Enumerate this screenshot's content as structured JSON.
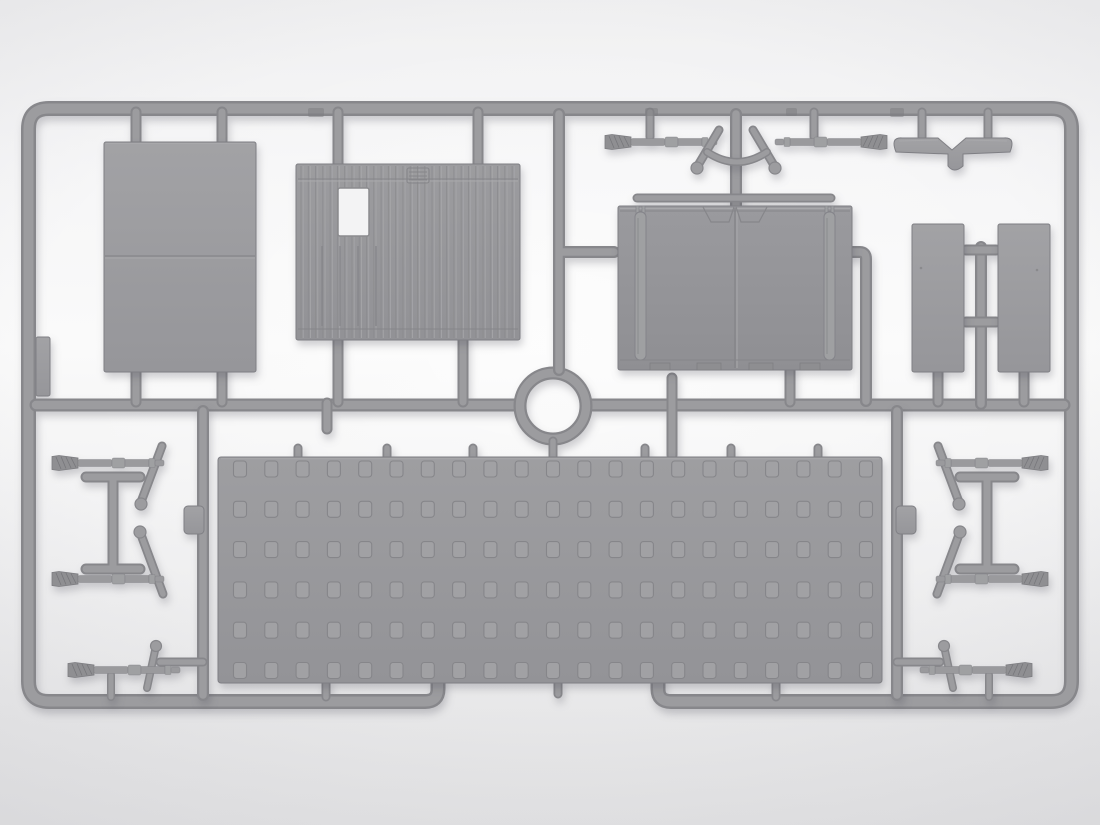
{
  "image": {
    "type": "photograph",
    "subject": "Gray injection-molded plastic model kit sprue (parts frame) on a light studio background",
    "orientation": "landscape",
    "visible_text": ""
  },
  "colors": {
    "bg_top": "#f0f0f1",
    "bg_mid": "#fafafa",
    "bg_bottom": "#e6e6e7",
    "runner_dark": "#87878b",
    "runner_light": "#9c9c9f",
    "part_light": "#a2a2a5",
    "part_dark": "#96969a",
    "corr_light": "#9c9c9f",
    "corr_dark": "#929296",
    "door_light": "#9a9a9e",
    "door_dark": "#8f8f93",
    "floor_light": "#9e9ea1",
    "floor_dark": "#939397",
    "outline": "#7f7f84",
    "detail_dark": "#86868a",
    "detail_light": "#a8a8ab",
    "hole_fill": "#a1a1a4",
    "window_fill": "#f3f3f4",
    "shadow": "rgba(70,70,85,0.25)"
  },
  "parts": [
    {
      "name": "roof-panel",
      "desc": "large plain rectangular panel with one horizontal seam",
      "count": 1
    },
    {
      "name": "corrugated-wall",
      "desc": "vertically ribbed wall panel with window cutout and small vent",
      "count": 1
    },
    {
      "name": "rear-doors",
      "desc": "double door panel with two vertical hinge rails and top rod",
      "count": 1
    },
    {
      "name": "side-plank",
      "desc": "narrow vertical rectangular plank",
      "count": 2
    },
    {
      "name": "mudguard-y-part",
      "desc": "winged bar with center notch and stem",
      "count": 1
    },
    {
      "name": "ring-connector",
      "desc": "circular ring moulded into the runner network",
      "count": 1
    },
    {
      "name": "perforated-floor",
      "desc": "large plate with grid of square dimples",
      "count": 1
    },
    {
      "name": "tool-rod-brush",
      "desc": "rod with brush tip, collars (cleaning rod / rifle)",
      "count": 8
    },
    {
      "name": "t-handle",
      "desc": "T-shaped handle bars joined by a stem",
      "count": 2
    },
    {
      "name": "diagonal-strut",
      "desc": "short angled rod with ball end",
      "count": 6
    },
    {
      "name": "bow-handle",
      "desc": "small curved bow piece",
      "count": 1
    }
  ],
  "floor_grid": {
    "cols": 21,
    "rows": 6,
    "x0": 240,
    "dx": 31.3,
    "y0": 469,
    "dy": 40.3,
    "hole_w": 13,
    "hole_h": 16,
    "rx": 3
  },
  "corrugation": {
    "count": 30,
    "x0": 301,
    "dx": 7.28,
    "y0": 166,
    "y1": 338
  }
}
